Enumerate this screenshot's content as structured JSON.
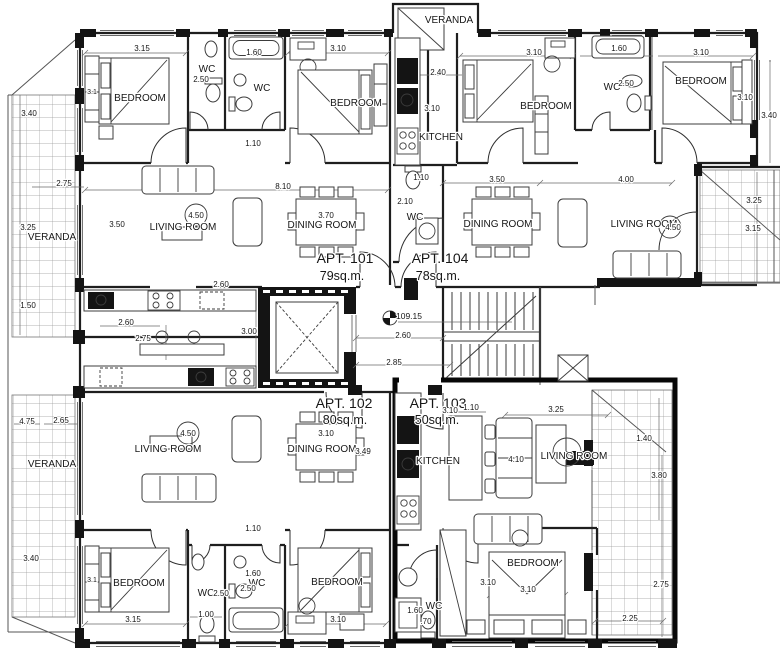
{
  "plan": {
    "level_marker": "109.15",
    "apartments": {
      "apt101": {
        "name": "APT. 101",
        "area": "79sq.m."
      },
      "apt102": {
        "name": "APT. 102",
        "area": "80sq.m."
      },
      "apt103": {
        "name": "APT. 103",
        "area": "50sq.m."
      },
      "apt104": {
        "name": "APT. 104",
        "area": "78sq.m."
      }
    },
    "rooms": {
      "v_top": "VERANDA",
      "v_left_top": "VERANDA",
      "v_left_bottom": "VERANDA",
      "a101_bed1": "BEDROOM",
      "a101_wc1": "WC",
      "a101_wc2": "WC",
      "a101_bed2": "BEDROOM",
      "a101_living": "LIVING ROOM",
      "a101_dining": "DINING ROOM",
      "a104_kitchen": "KITCHEN",
      "a104_bed1": "BEDROOM",
      "a104_wc1": "WC",
      "a104_bed2": "BEDROOM",
      "a104_wc2": "WC",
      "a104_dining": "DINING ROOM",
      "a104_living": "LIVING ROOM",
      "a102_living": "LIVING ROOM",
      "a102_dining": "DINING ROOM",
      "a102_bed1": "BEDROOM",
      "a102_wc1": "WC",
      "a102_wc2": "WC",
      "a102_bed2": "BEDROOM",
      "a103_kitchen": "KITCHEN",
      "a103_living": "LIVING ROOM",
      "a103_bed": "BEDROOM",
      "a103_wc": "WC"
    },
    "dims": {
      "d01": "3.15",
      "d02": "2.50",
      "d03": "1.60",
      "d04": "3.10",
      "d05": "3.40",
      "d06": "3.1",
      "d07": "1.10",
      "d08": "2.75",
      "d09": "8.10",
      "d10": "3.25",
      "d11": "3.50",
      "d12": "4.50",
      "d13": "3.70",
      "d14": "1.50",
      "d15": "2.60",
      "d16": "2.60",
      "d17": "2.75",
      "d18": "3.00",
      "d19": "2.40",
      "d20": "3.10",
      "d21": "1.60",
      "d22": "3.10",
      "d23": "3.10",
      "d24": "3.40",
      "d25": "1.10",
      "d26": "2.10",
      "d27": "3.50",
      "d28": "4.00",
      "d29": "4.50",
      "d30": "3.25",
      "d31": "3.15",
      "d32": "3.10",
      "d33": "2.60",
      "d34": "2.85",
      "d35": "4.75",
      "d36": "2.65",
      "d37": "4.50",
      "d38": "3.10",
      "d39": "3.49",
      "d40": "1.10",
      "d41": "3.40",
      "d42": "3.1",
      "d43": "1.60",
      "d44": "2.50",
      "d45": "2.50",
      "d46": "1.00",
      "d47": "3.15",
      "d48": "3.10",
      "d49": "3.10",
      "d50": "1.10",
      "d51": "3.25",
      "d52": "4.10",
      "d53": "1.40",
      "d54": "3.80",
      "d55": "3.10",
      "d56": "3.10",
      "d57": "1.60",
      "d58": ".70",
      "d59": "2.75",
      "d60": "2.25",
      "d61": "2.50"
    }
  }
}
